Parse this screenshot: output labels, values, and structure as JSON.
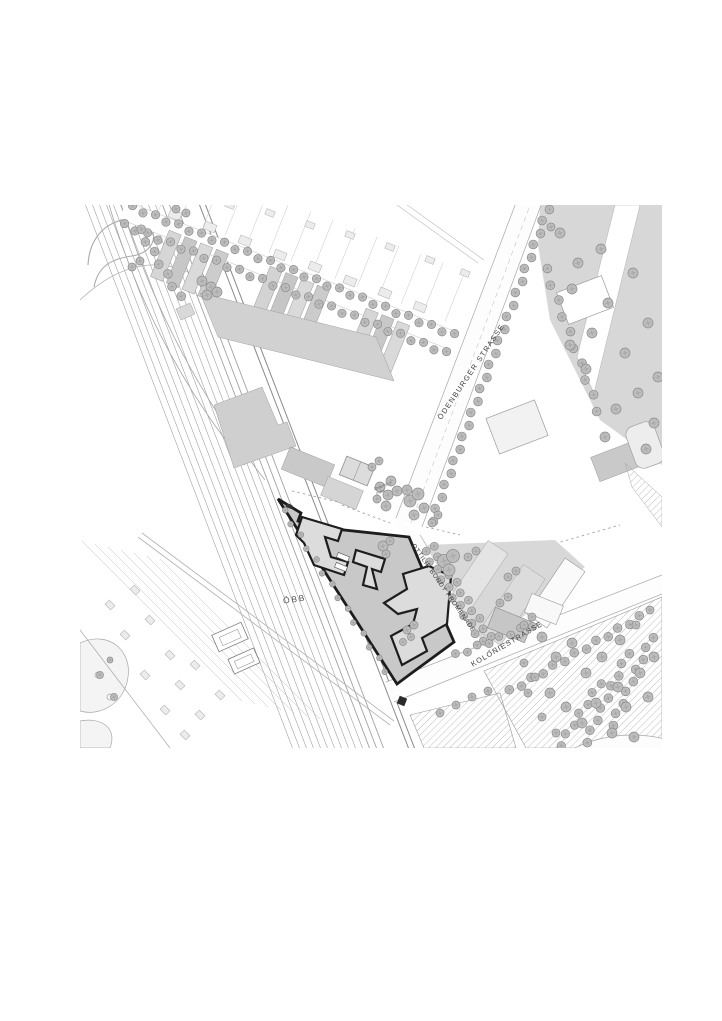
{
  "page": {
    "background": "#ffffff"
  },
  "map": {
    "labels": {
      "odenburger": "ÖDENBURGER STRASSE",
      "promenade": "OTTILIE BONDY PROMENADE",
      "kolonie": "KOLONIESTRASSE",
      "obb": "ÖBB",
      "quartier_line1": "Quartiers",
      "quartier_line2": "platz"
    },
    "colors": {
      "site_boundary": "#1d1d1d",
      "site_fill": "#c8c8c8",
      "building_fill": "#d1d1d1",
      "tree_fill": "#bcbcbc",
      "line_work": "#9a9a9a",
      "street_fill": "#fdfdfd"
    }
  }
}
